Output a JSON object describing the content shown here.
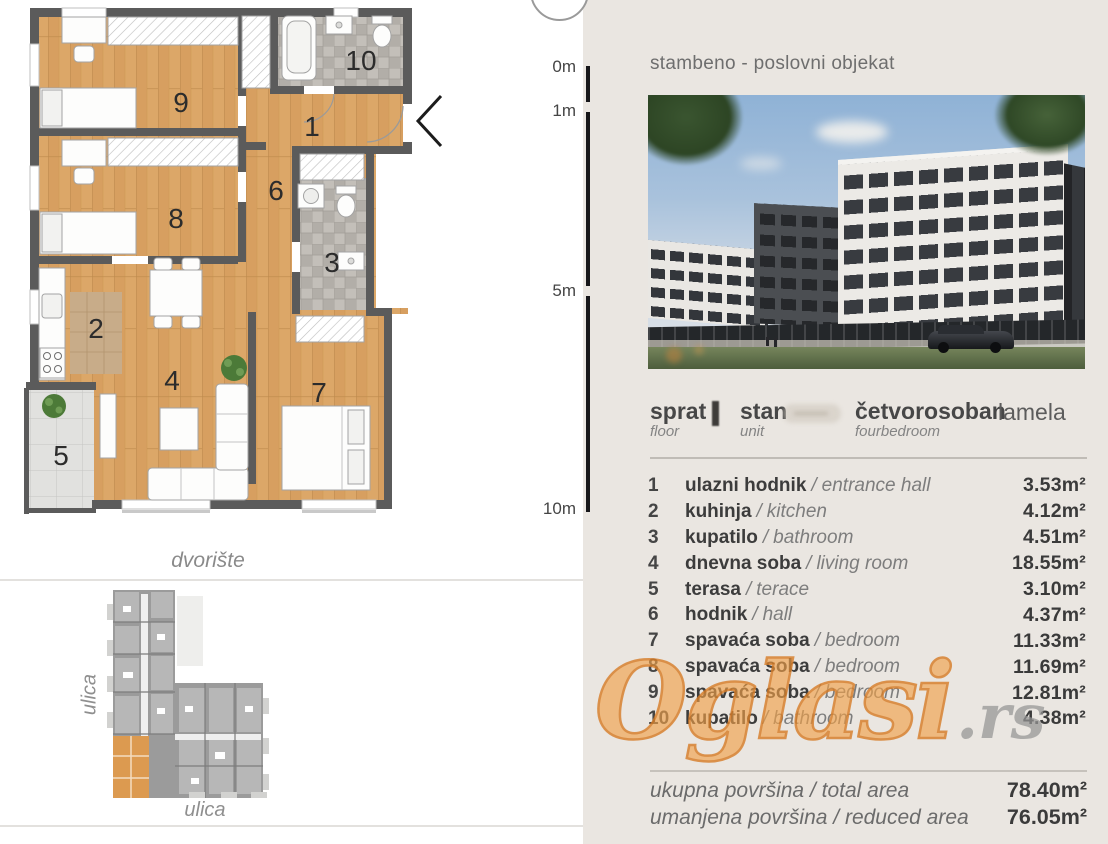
{
  "floor_plan": {
    "room_numbers": [
      "1",
      "2",
      "3",
      "4",
      "5",
      "6",
      "7",
      "8",
      "9",
      "10"
    ],
    "courtyard_label": "dvorište",
    "street_label_left": "ulica",
    "street_label_bottom": "ulica"
  },
  "scale_ruler": {
    "marks": [
      "0m",
      "1m",
      "5m",
      "10m"
    ]
  },
  "listing": {
    "title": "stambeno - poslovni objekat",
    "info_row": {
      "floor_sr": "sprat",
      "floor_en": "floor",
      "unit_sr": "stan",
      "unit_en": "unit",
      "type_sr": "četvorosoban",
      "type_en": "fourbedroom",
      "block_label": "lamela"
    },
    "separator": "/",
    "rooms": [
      {
        "num": "1",
        "name_sr": "ulazni hodnik",
        "name_en": "entrance hall",
        "area": "3.53m²"
      },
      {
        "num": "2",
        "name_sr": "kuhinja",
        "name_en": "kitchen",
        "area": "4.12m²"
      },
      {
        "num": "3",
        "name_sr": "kupatilo",
        "name_en": "bathroom",
        "area": "4.51m²"
      },
      {
        "num": "4",
        "name_sr": "dnevna soba",
        "name_en": "living room",
        "area": "18.55m²"
      },
      {
        "num": "5",
        "name_sr": "terasa",
        "name_en": "terace",
        "area": "3.10m²"
      },
      {
        "num": "6",
        "name_sr": "hodnik",
        "name_en": "hall",
        "area": "4.37m²"
      },
      {
        "num": "7",
        "name_sr": "spavaća soba",
        "name_en": "bedroom",
        "area": "11.33m²"
      },
      {
        "num": "8",
        "name_sr": "spavaća soba",
        "name_en": "bedroom",
        "area": "11.69m²"
      },
      {
        "num": "9",
        "name_sr": "spavaća soba",
        "name_en": "bedroom",
        "area": "12.81m²"
      },
      {
        "num": "10",
        "name_sr": "kupatilo",
        "name_en": "bathroom",
        "area": "4.38m²"
      }
    ],
    "totals": [
      {
        "label": "ukupna površina / total area",
        "value": "78.40m²"
      },
      {
        "label": "umanjena površina / reduced area",
        "value": "76.05m²"
      }
    ]
  },
  "watermark": {
    "main": "Oglasi",
    "suffix": ".rs"
  },
  "colors": {
    "panel_bg": "#eae6e1",
    "wood": "#d9a463",
    "wall": "#5b5b5b",
    "tile": "#bdb9b3",
    "terrace_tile": "#e0e0de",
    "highlight_unit": "#dc9a50",
    "watermark_orange": "#e7953f",
    "watermark_gray": "#949494"
  }
}
